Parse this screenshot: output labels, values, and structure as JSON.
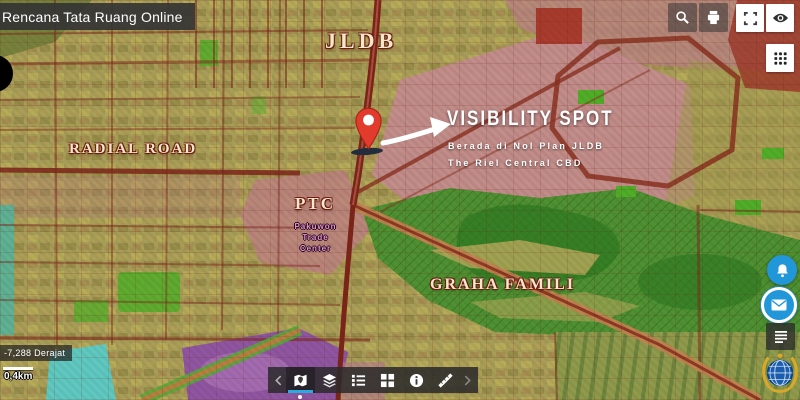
{
  "header": {
    "title": "Rencana Tata Ruang Online"
  },
  "map_labels": {
    "jldb": "JLDB",
    "radial_road": "RADIAL ROAD",
    "ptc": "PTC",
    "ptc_sub1": "Pakuwon",
    "ptc_sub2": "Trade",
    "ptc_sub3": "Center",
    "graha_famili": "GRAHA FAMILI"
  },
  "annotation": {
    "title": "VISIBILITY SPOT",
    "line1": "Berada di Nol Plan JLDB",
    "line2": "The Riel Central CBD"
  },
  "statusbar": {
    "coordinates": "-7,288 Derajat",
    "scale_label": "0,4km"
  },
  "icons": {
    "search": "magnifier",
    "print": "printer",
    "fullscreen": "expand-corners",
    "visibility": "eye",
    "apps": "3x3-dot-grid",
    "notifications": "bell",
    "contact": "envelope",
    "legend_panel": "list-lines",
    "ministry_logo": "globe-with-gold-wheat",
    "toolbar": [
      "chevron-left",
      "basemap-map-pin",
      "layers",
      "legend-list",
      "grid-2x2",
      "info",
      "measure-pencil",
      "chevron-right"
    ]
  },
  "colors": {
    "accent_blue": "#29abe2",
    "button_blue": "#2196d8",
    "pin_red": "#e23b2e",
    "label_cream": "#f3e8cc",
    "label_outline": "#6e1b10",
    "ptc_sub_pink": "#ef8fd9"
  }
}
